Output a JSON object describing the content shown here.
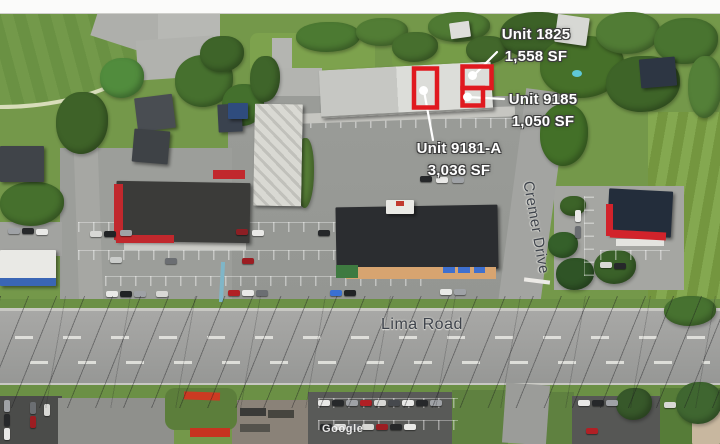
{
  "title": "Aerial leasing site map",
  "attribution": "Google",
  "roads": {
    "lima": "Lima Road",
    "cremer": "Cremer Drive"
  },
  "units": [
    {
      "name": "Unit 1825",
      "size": "1,558 SF"
    },
    {
      "name": "Unit 9185",
      "size": "1,050 SF"
    },
    {
      "name": "Unit 9181-A",
      "size": "3,036 SF"
    }
  ],
  "colors": {
    "unit_highlight": "#e0191f",
    "leader_line": "#ffffff",
    "unit_label_text": "#ffffff",
    "road_label_text": "#3f444c"
  }
}
